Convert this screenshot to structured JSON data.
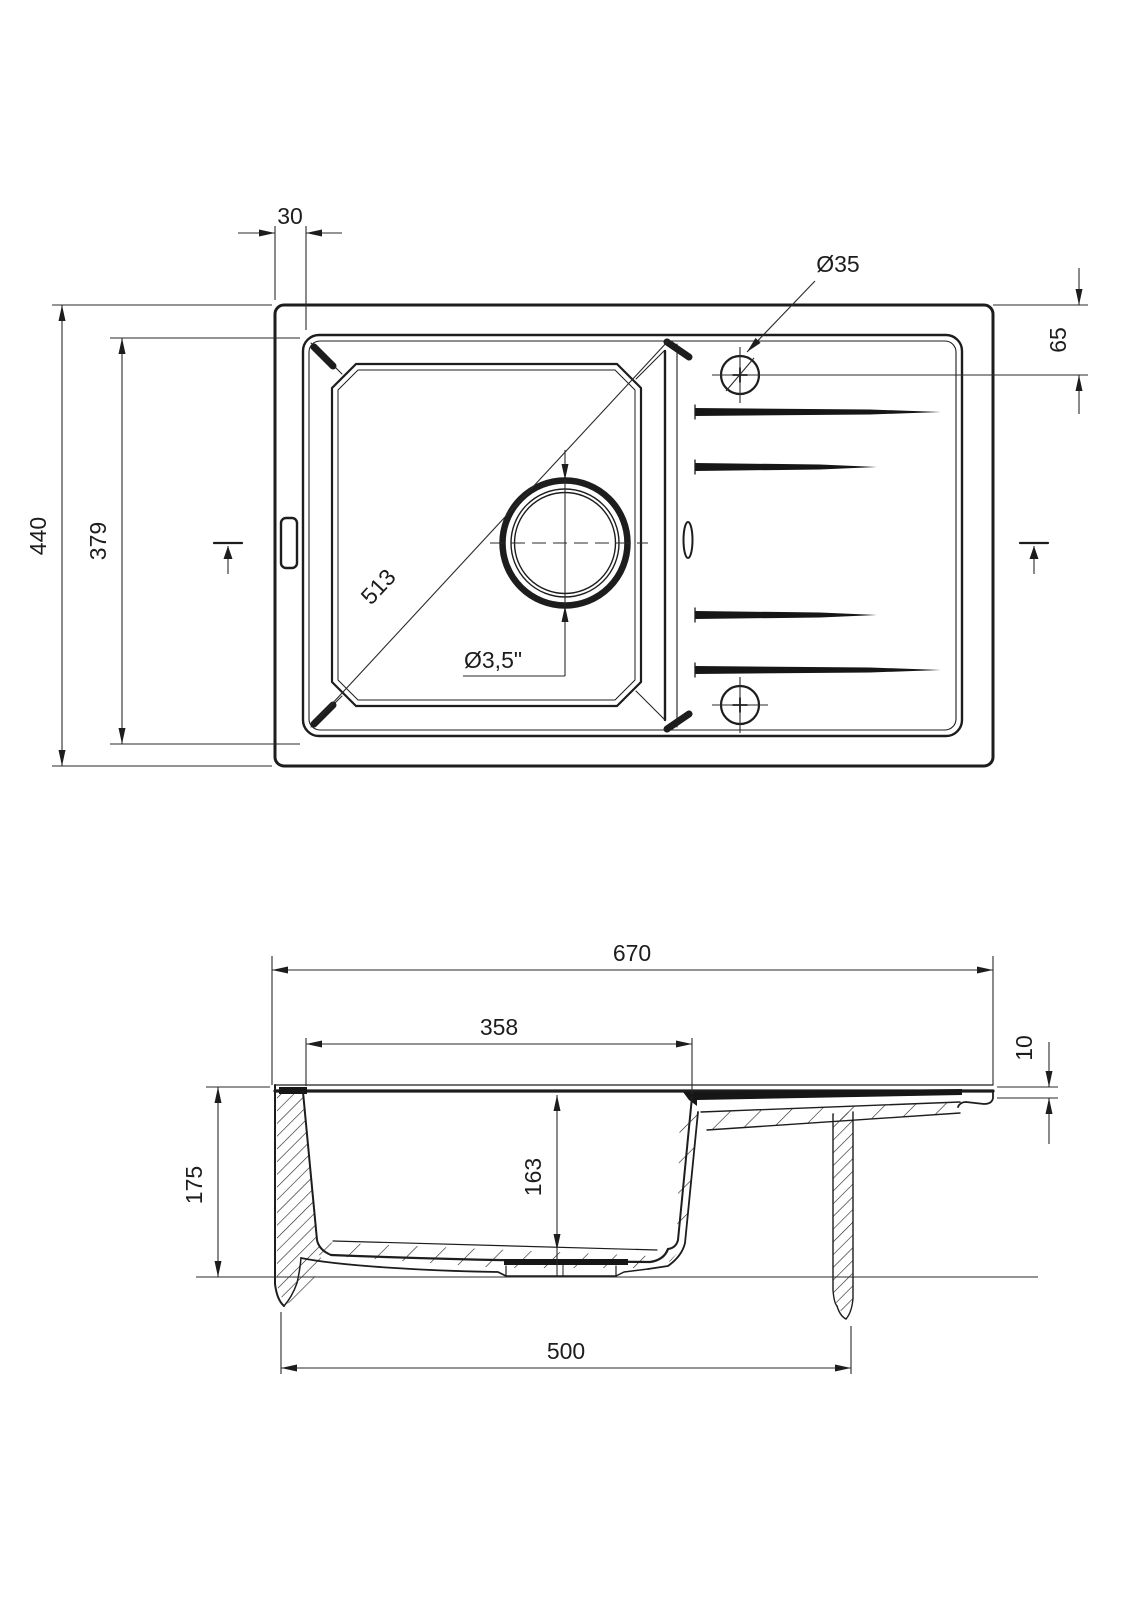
{
  "drawing": {
    "type": "sink-technical-drawing",
    "colors": {
      "line": "#1d1d1d",
      "background": "#ffffff"
    },
    "top_view": {
      "dims": {
        "rim_offset": "30",
        "faucet_hole_dia": "Ø35",
        "faucet_hole_offset": "65",
        "overall_depth": "440",
        "inner_depth": "379",
        "bowl_diagonal": "513",
        "drain_dia": "Ø3,5\""
      }
    },
    "section_view": {
      "dims": {
        "overall_width": "670",
        "bowl_width": "358",
        "rim_thickness": "10",
        "overall_height": "175",
        "bowl_depth": "163",
        "base_width": "500"
      }
    }
  }
}
